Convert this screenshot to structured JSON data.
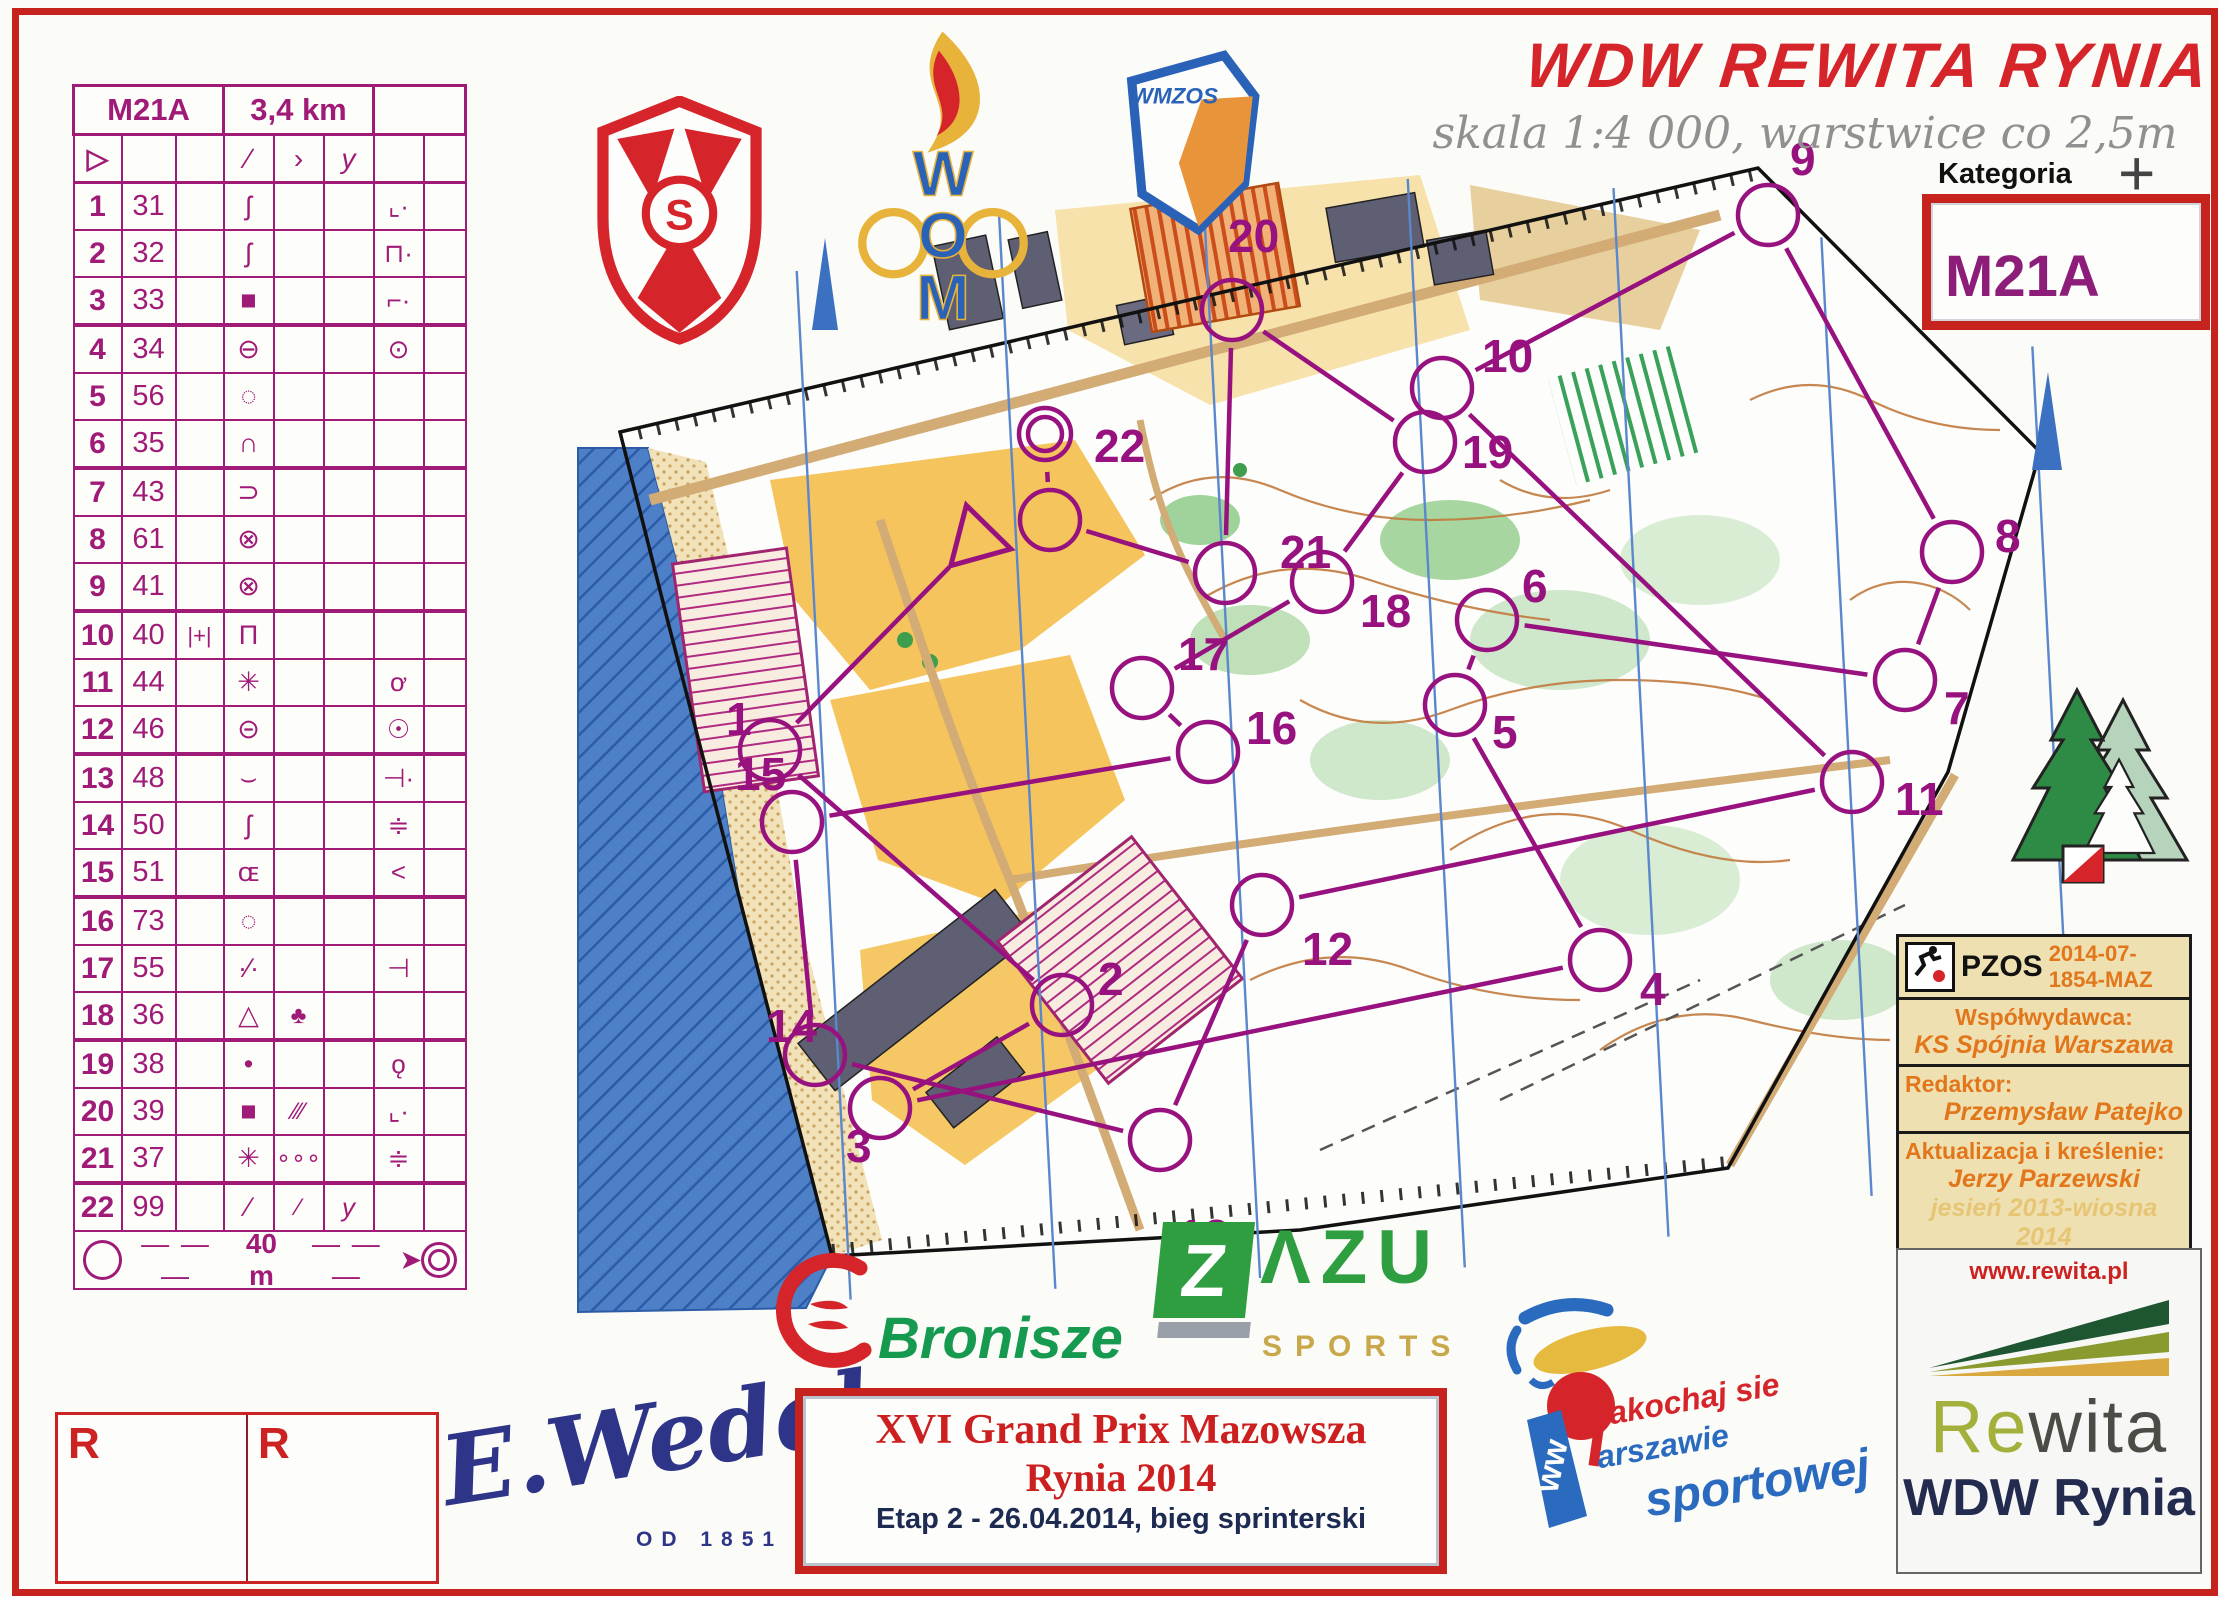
{
  "title": {
    "text": "WDW REWITA RYNIA",
    "subtitle": "skala 1:4 000, warstwice co 2,5m",
    "kategoria_label": "Kategoria",
    "kategoria_value": "M21A",
    "crosshair": "+"
  },
  "descriptions": {
    "event": "M21A",
    "length": "3,4 km",
    "start_symbol": "▷",
    "header_symbols": {
      "a": "▷",
      "d": "∕",
      "e": "›",
      "f": "y"
    },
    "scale_label": "40 m",
    "scale_dashes": "— — —",
    "rows": [
      {
        "n": "1",
        "code": "31",
        "c": "",
        "d": "ʃ",
        "e": "",
        "f": "",
        "g": "⌞·",
        "h": ""
      },
      {
        "n": "2",
        "code": "32",
        "c": "",
        "d": "ʃ",
        "e": "",
        "f": "",
        "g": "⊓·",
        "h": ""
      },
      {
        "n": "3",
        "code": "33",
        "c": "",
        "d": "■",
        "e": "",
        "f": "",
        "g": "⌐·",
        "h": ""
      },
      {
        "n": "4",
        "code": "34",
        "c": "",
        "d": "⊖",
        "e": "",
        "f": "",
        "g": "⊙",
        "h": ""
      },
      {
        "n": "5",
        "code": "56",
        "c": "",
        "d": "◌",
        "e": "",
        "f": "",
        "g": "",
        "h": ""
      },
      {
        "n": "6",
        "code": "35",
        "c": "",
        "d": "∩",
        "e": "",
        "f": "",
        "g": "",
        "h": ""
      },
      {
        "n": "7",
        "code": "43",
        "c": "",
        "d": "⊃",
        "e": "",
        "f": "",
        "g": "",
        "h": ""
      },
      {
        "n": "8",
        "code": "61",
        "c": "",
        "d": "⊗",
        "e": "",
        "f": "",
        "g": "",
        "h": ""
      },
      {
        "n": "9",
        "code": "41",
        "c": "",
        "d": "⊗",
        "e": "",
        "f": "",
        "g": "",
        "h": ""
      },
      {
        "n": "10",
        "code": "40",
        "c": "|+|",
        "d": "Π",
        "e": "",
        "f": "",
        "g": "",
        "h": ""
      },
      {
        "n": "11",
        "code": "44",
        "c": "",
        "d": "✳",
        "e": "",
        "f": "",
        "g": "ơ",
        "h": ""
      },
      {
        "n": "12",
        "code": "46",
        "c": "",
        "d": "⊝",
        "e": "",
        "f": "",
        "g": "☉",
        "h": ""
      },
      {
        "n": "13",
        "code": "48",
        "c": "",
        "d": "⌣",
        "e": "",
        "f": "",
        "g": "⊣·",
        "h": ""
      },
      {
        "n": "14",
        "code": "50",
        "c": "",
        "d": "ʃ",
        "e": "",
        "f": "",
        "g": "≑",
        "h": ""
      },
      {
        "n": "15",
        "code": "51",
        "c": "",
        "d": "ɶ",
        "e": "",
        "f": "",
        "g": "<",
        "h": ""
      },
      {
        "n": "16",
        "code": "73",
        "c": "",
        "d": "◌",
        "e": "",
        "f": "",
        "g": "",
        "h": ""
      },
      {
        "n": "17",
        "code": "55",
        "c": "",
        "d": "∙∕∙",
        "e": "",
        "f": "",
        "g": "⊣",
        "h": ""
      },
      {
        "n": "18",
        "code": "36",
        "c": "",
        "d": "△",
        "e": "♣",
        "f": "",
        "g": "",
        "h": ""
      },
      {
        "n": "19",
        "code": "38",
        "c": "",
        "d": "•",
        "e": "",
        "f": "",
        "g": "ǫ",
        "h": ""
      },
      {
        "n": "20",
        "code": "39",
        "c": "",
        "d": "■",
        "e": "∕∕∕",
        "f": "",
        "g": "⌞·",
        "h": ""
      },
      {
        "n": "21",
        "code": "37",
        "c": "",
        "d": "✳",
        "e": "∘∘∘",
        "f": "",
        "g": "≑",
        "h": ""
      },
      {
        "n": "22",
        "code": "99",
        "c": "",
        "d": "∕",
        "e": "⁄",
        "f": "y",
        "g": "",
        "h": ""
      }
    ]
  },
  "map": {
    "course_color": "#98127f",
    "north_color": "#5b87cc",
    "start": {
      "x": 976,
      "y": 540
    },
    "finish": {
      "x": 1045,
      "y": 434
    },
    "controls": [
      {
        "n": "1",
        "x": 770,
        "y": 750,
        "lx": 726,
        "ly": 735
      },
      {
        "n": "2",
        "x": 1062,
        "y": 1005,
        "lx": 1098,
        "ly": 995
      },
      {
        "n": "3",
        "x": 880,
        "y": 1108,
        "lx": 846,
        "ly": 1162
      },
      {
        "n": "4",
        "x": 1600,
        "y": 960,
        "lx": 1640,
        "ly": 1005
      },
      {
        "n": "5",
        "x": 1455,
        "y": 705,
        "lx": 1492,
        "ly": 748
      },
      {
        "n": "6",
        "x": 1487,
        "y": 620,
        "lx": 1522,
        "ly": 602
      },
      {
        "n": "7",
        "x": 1905,
        "y": 680,
        "lx": 1944,
        "ly": 724
      },
      {
        "n": "8",
        "x": 1952,
        "y": 552,
        "lx": 1995,
        "ly": 552
      },
      {
        "n": "9",
        "x": 1768,
        "y": 215,
        "lx": 1790,
        "ly": 175
      },
      {
        "n": "10",
        "x": 1442,
        "y": 388,
        "lx": 1482,
        "ly": 372
      },
      {
        "n": "11",
        "x": 1852,
        "y": 782,
        "lx": 1895,
        "ly": 815
      },
      {
        "n": "12",
        "x": 1262,
        "y": 905,
        "lx": 1302,
        "ly": 965
      },
      {
        "n": "13",
        "x": 1160,
        "y": 1140,
        "lx": 1178,
        "ly": 1252
      },
      {
        "n": "14",
        "x": 815,
        "y": 1055,
        "lx": 766,
        "ly": 1042
      },
      {
        "n": "15",
        "x": 792,
        "y": 822,
        "lx": 735,
        "ly": 790
      },
      {
        "n": "16",
        "x": 1208,
        "y": 752,
        "lx": 1246,
        "ly": 744
      },
      {
        "n": "17",
        "x": 1142,
        "y": 688,
        "lx": 1178,
        "ly": 670
      },
      {
        "n": "18",
        "x": 1322,
        "y": 582,
        "lx": 1360,
        "ly": 627
      },
      {
        "n": "19",
        "x": 1425,
        "y": 442,
        "lx": 1462,
        "ly": 468
      },
      {
        "n": "20",
        "x": 1232,
        "y": 310,
        "lx": 1228,
        "ly": 252
      },
      {
        "n": "21",
        "x": 1225,
        "y": 573,
        "lx": 1280,
        "ly": 568
      },
      {
        "n": "22",
        "x": 1050,
        "y": 520,
        "lx": 1094,
        "ly": 462
      }
    ]
  },
  "info_box": {
    "org": "PZOS",
    "code": "2014-07-1854-MAZ",
    "co_label": "Współwydawca:",
    "co_value": "KS Spójnia Warszawa",
    "ed_label": "Redaktor:",
    "ed_value": "Przemysław Patejko",
    "up_label": "Aktualizacja i kreślenie:",
    "up_value": "Jerzy Parzewski",
    "up_date": "jesień 2013-wiosna 2014",
    "base_label": "Mapa podkładowa:",
    "base_value": "MT 1:10 000"
  },
  "rewita": {
    "url": "www.rewita.pl",
    "brand_head": "Re",
    "brand_tail": "wita",
    "name": "WDW Rynia"
  },
  "event_box": {
    "line1": "XVI Grand Prix Mazowsza",
    "line2": "Rynia 2014",
    "line3": "Etap 2 - 26.04.2014, bieg sprinterski"
  },
  "sponsors": {
    "wedel": "E.Wedel",
    "wedel_since": "OD 1851",
    "bronisze": "Bronisze",
    "zazu_z": "Z",
    "zazu_rest": "ΛZU",
    "zazu_sub": "SPORTS",
    "syrenka_l1": "zakochaj sie",
    "syrenka_w": "w",
    "syrenka_l2": "arszawie",
    "syrenka_l3": "sportowej",
    "wom": "WOM",
    "wmzos": "WMZOS",
    "spojnia_letter": "S"
  },
  "reserve": {
    "label1": "R",
    "label2": "R"
  }
}
